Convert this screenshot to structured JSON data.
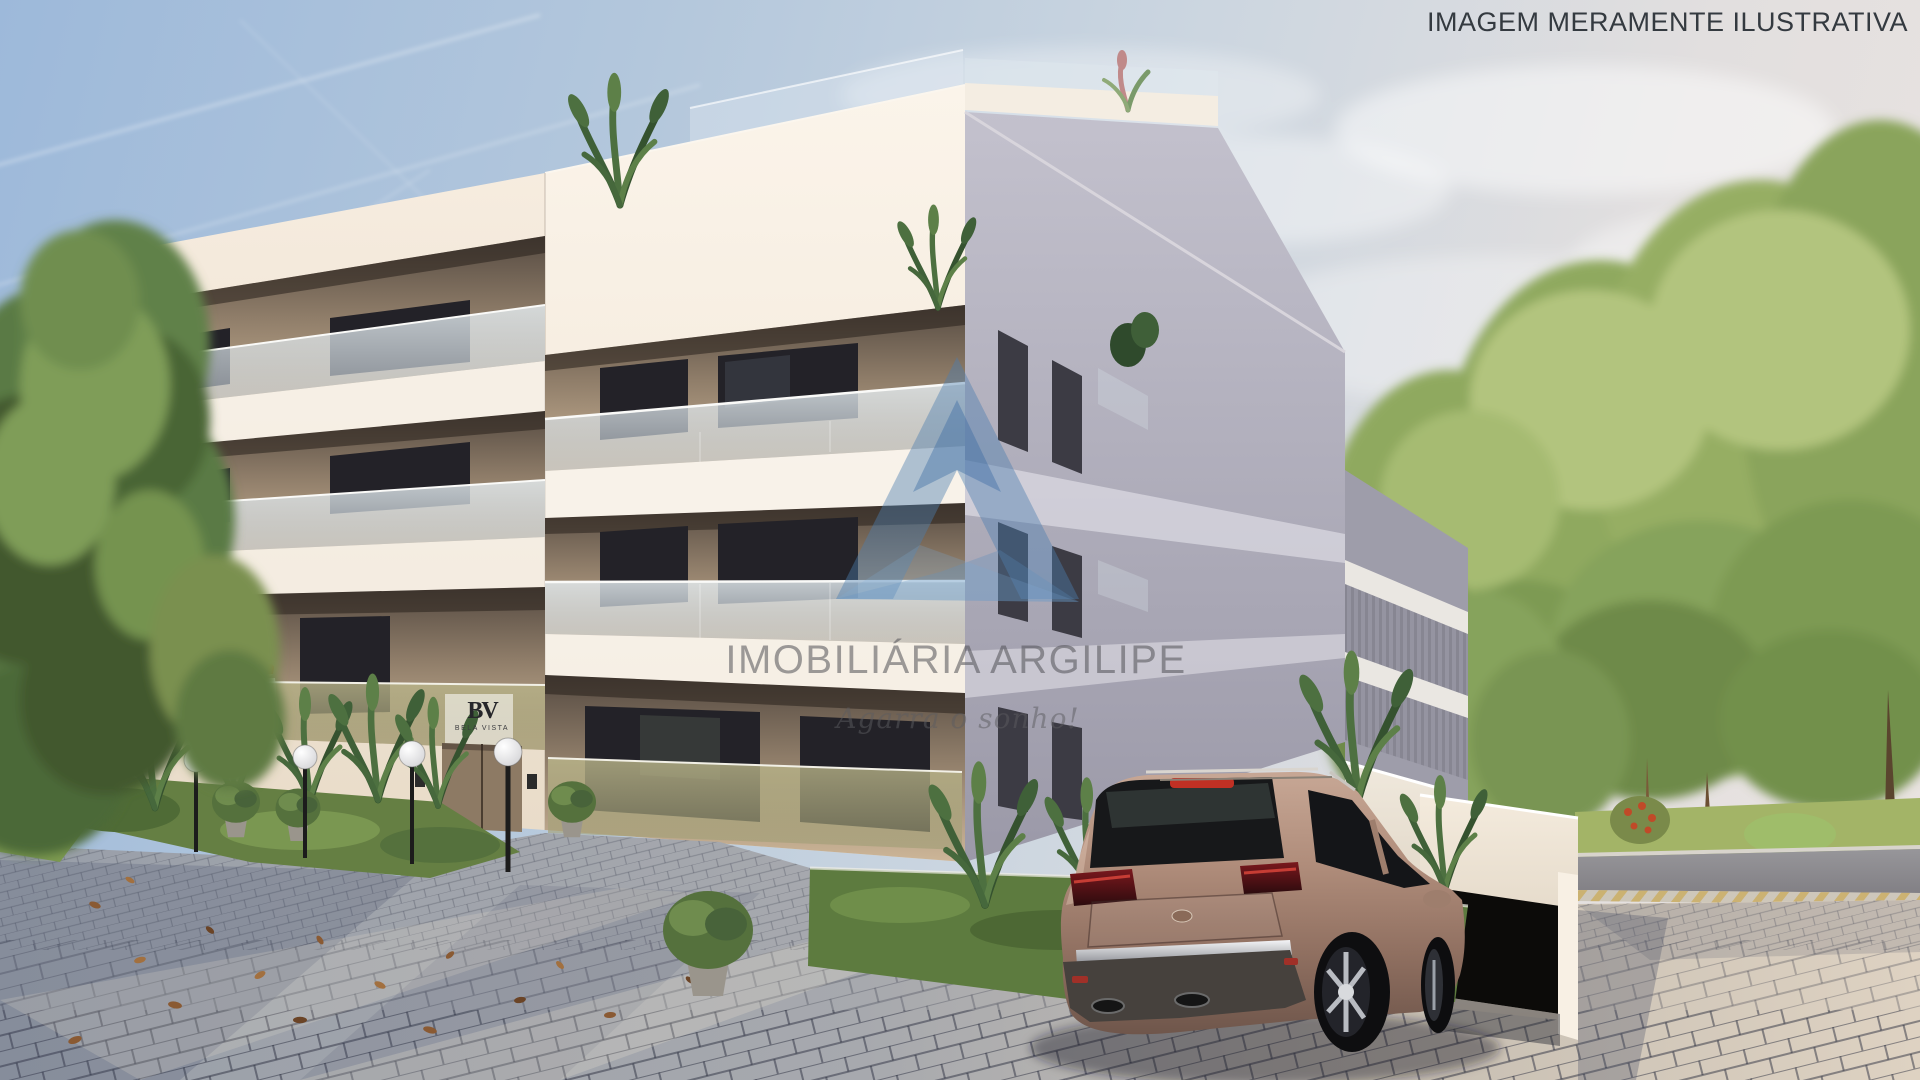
{
  "disclaimer": {
    "text": "IMAGEM MERAMENTE ILUSTRATIVA",
    "color": "#343a40"
  },
  "watermark": {
    "logo": "peak-triangle-logo",
    "logo_color": "#4b7db1",
    "brand": "IMOBILIÁRIA ARGILIPE",
    "slogan": "Agarra o sonho!",
    "text_color": "#55555a"
  },
  "entrance_sign": {
    "monogram": "BV",
    "name": "BELA VISTA"
  },
  "scene": {
    "type": "3d architectural exterior render",
    "subject": "Modern cream three-storey apartment building with recessed balconies, glass railings and roof terrace",
    "sky": "day, light blue with thin clouds and contrails",
    "foreground": [
      "grey cobblestone pavement with scattered fallen leaves",
      "bronze SUV parked in front of the underground garage entrance",
      "tropical plants, round shrubs and raised grass beds",
      "black street lamps with white globe lights",
      "woman standing on ground-floor balcony"
    ],
    "background": [
      "dense green trees on both sides",
      "street with light kerb hatching",
      "white boundary wall and garage block",
      "small white car behind the wall"
    ],
    "palette": {
      "sky_top": "#9db9da",
      "sky_horizon": "#eae4e0",
      "facade_sunlit": "#f7efe6",
      "facade_shadow": "#b0aebc",
      "balcony_recess": "#5c5148",
      "balcony_interior": "#cdb698",
      "glass_upper": "#dde6ea",
      "glass_ground_olive": "#b7b287",
      "window_frame": "#232228",
      "pavement_shadow": "#999fa9",
      "pavement_sunlit": "#ded2c2",
      "grass": "#9cb165",
      "trees_left": "#5a7a44",
      "trees_right": "#8fa95f",
      "car_body": "#ad8a79",
      "car_taillight": "#6b1418",
      "road": "#8e8d92"
    }
  }
}
